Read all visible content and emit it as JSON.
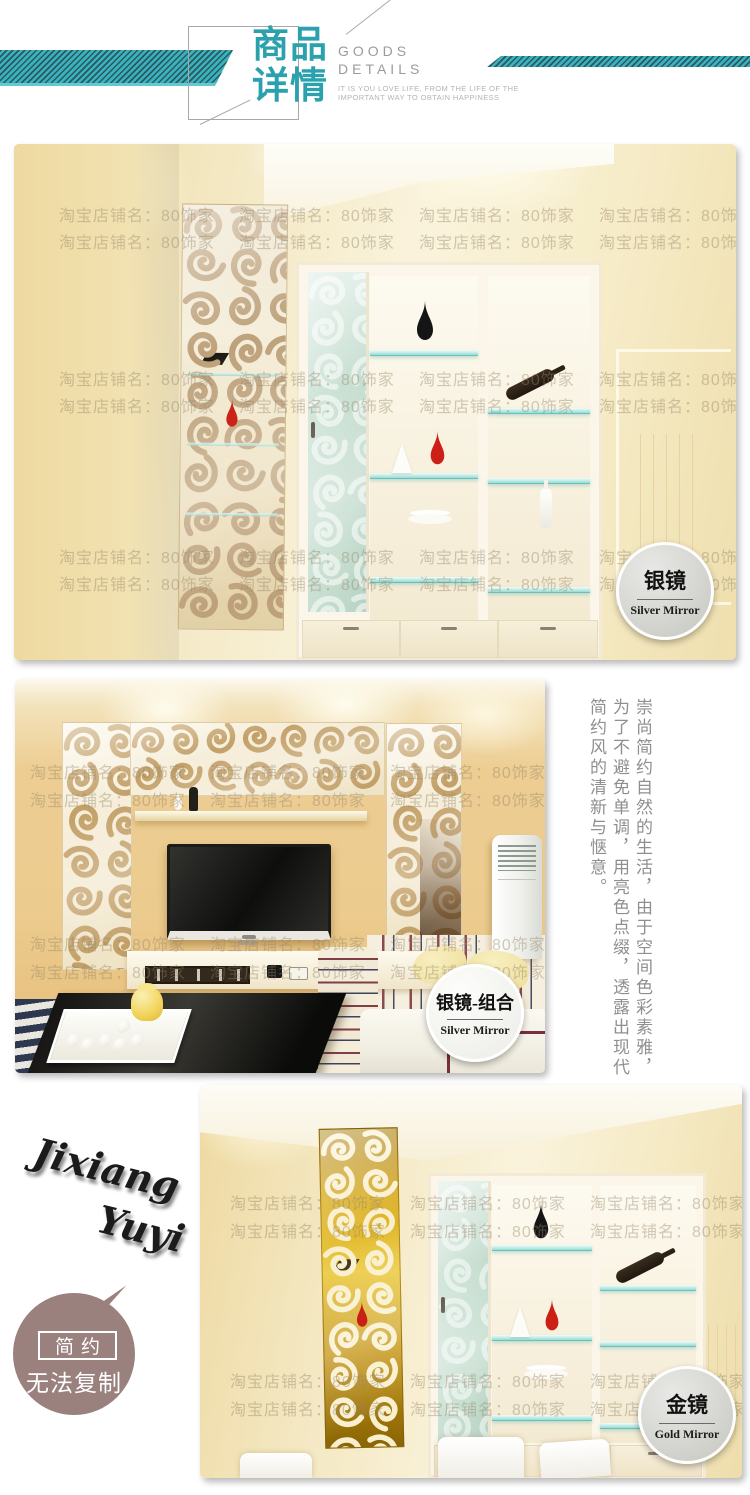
{
  "header": {
    "title": "商品\n详情",
    "subtitle_line1": "GOODS",
    "subtitle_line2": "DETAILS",
    "tagline_line1": "IT IS YOU LOVE LIFE, FROM THE LIFE OF THE",
    "tagline_line2": "IMPORTANT WAY TO OBTAIN HAPPINESS",
    "accent_color": "#2aa1ad"
  },
  "watermark": {
    "text": "淘宝店铺名：80饰家"
  },
  "sections": [
    {
      "name": "silver-mirror-room",
      "badge_title": "银镜",
      "badge_subtitle": "Silver Mirror"
    },
    {
      "name": "silver-mirror-combo-living-room",
      "badge_title": "银镜-组合",
      "badge_subtitle": "Silver Mirror",
      "side_text": "崇尚简约自然的生活，由于空间色彩素雅，为了不避免单调，用亮色点缀，透露出现代简约风的清新与惬意。"
    },
    {
      "name": "gold-mirror-room",
      "badge_title": "金镜",
      "badge_subtitle": "Gold Mirror",
      "brand_script_line1": "Jixiang",
      "brand_script_line2": "Yuyi",
      "stamp_box_label": "简约",
      "stamp_caption": "无法复制"
    }
  ],
  "colors": {
    "accent_teal": "#2aa1ad",
    "silver_swirl": "#bda17a",
    "gold_mirror": "#d9ab1c",
    "stamp_mauve": "#9a817e",
    "wall_cream": "#f3e7c0",
    "wall_tan": "#eccb8e"
  }
}
